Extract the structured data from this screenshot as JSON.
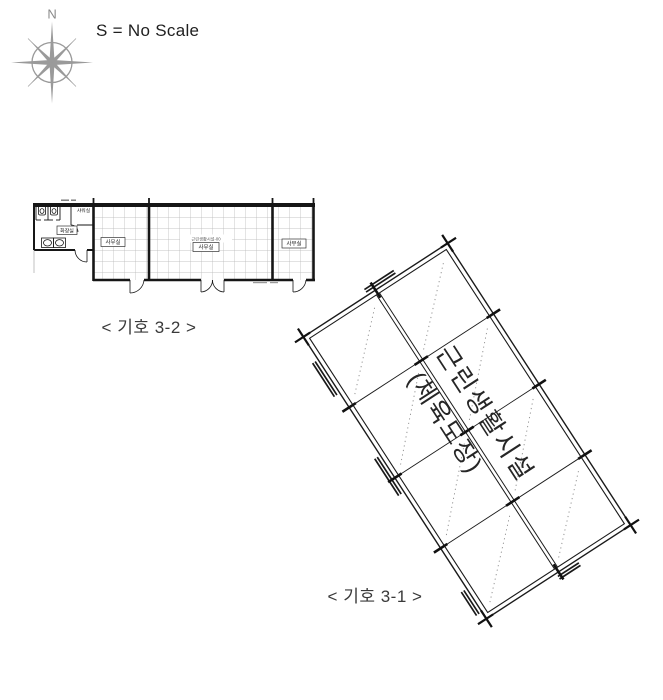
{
  "scale_note": "S = No Scale",
  "compass": {
    "north_label": "N"
  },
  "small_plan": {
    "caption": "< 기호 3-2 >",
    "labels": {
      "toilet": "화장실",
      "shower": "샤워실",
      "office_left": "사무실",
      "office_center_note": "근린생활시설-00",
      "office_center": "사무실",
      "office_right": "사무실"
    }
  },
  "large_plan": {
    "caption": "< 기호 3-1 >",
    "name_line1": "근린생활시설",
    "name_line2": "(체육도장)"
  },
  "colors": {
    "ink": "#1a1a1a",
    "grid": "#b4b4b4",
    "compass": "#9a9a9a",
    "dash": "#8a8a8a"
  }
}
